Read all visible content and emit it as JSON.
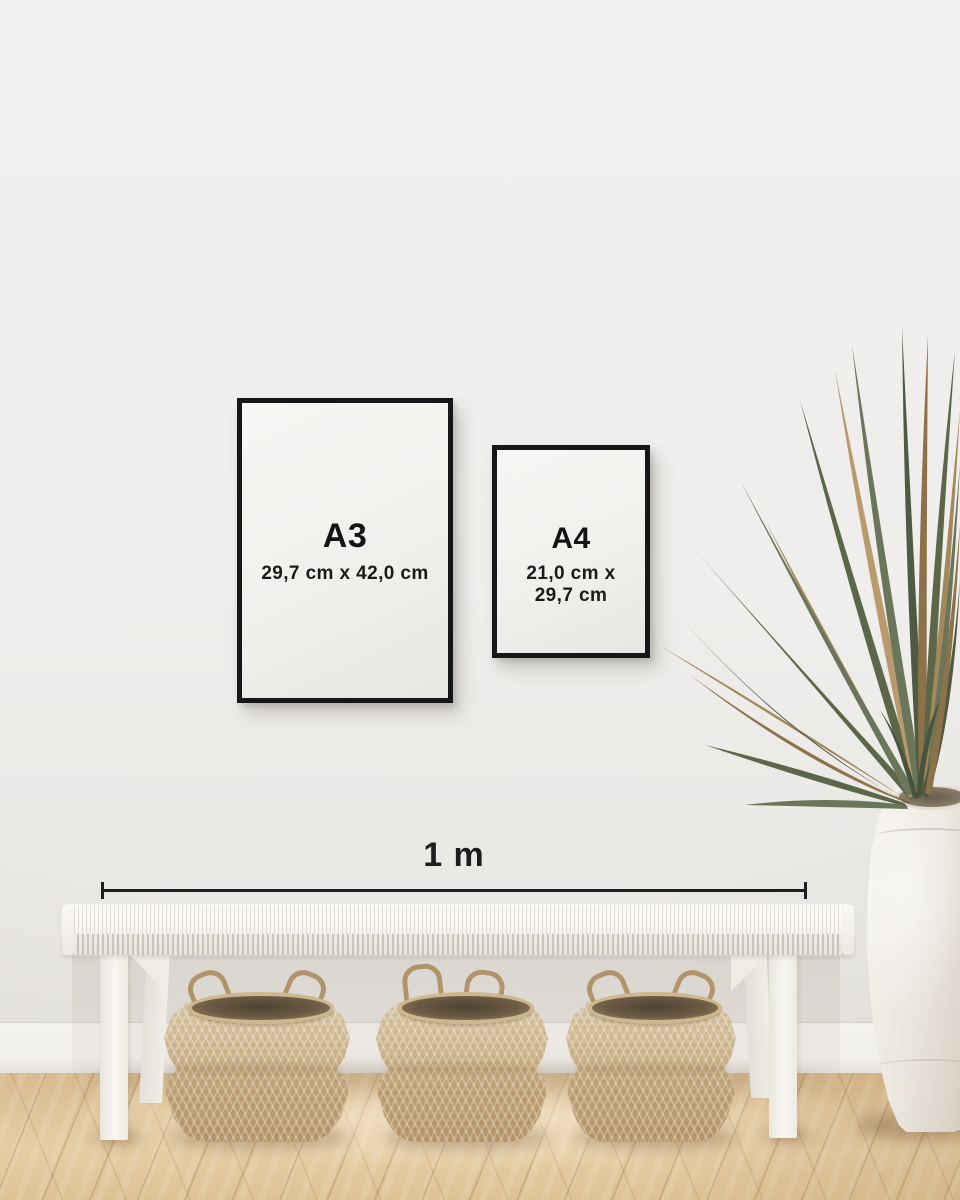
{
  "scene": {
    "description": "Wall mockup comparing poster sizes A3 and A4 above a white bench with seagrass baskets, dried palm plant in ceramic vase, wooden herringbone floor"
  },
  "posters": {
    "a3": {
      "label": "A3",
      "dimensions": "29,7 cm x 42,0 cm"
    },
    "a4": {
      "label": "A4",
      "dimensions_line1": "21,0 cm x",
      "dimensions_line2": "29,7 cm"
    }
  },
  "scale": {
    "label": "1 m"
  },
  "colors": {
    "wall": "#f0efed",
    "frame": "#17171a",
    "text": "#141414",
    "scale_line": "#1f1f21",
    "floor_wood": "#dfc49a",
    "bench_white": "#f7f5f1",
    "basket_tan": "#c3a87e",
    "plant_green": "#5c6749",
    "plant_dried": "#a3885a",
    "vase_cream": "#ece8e1"
  }
}
